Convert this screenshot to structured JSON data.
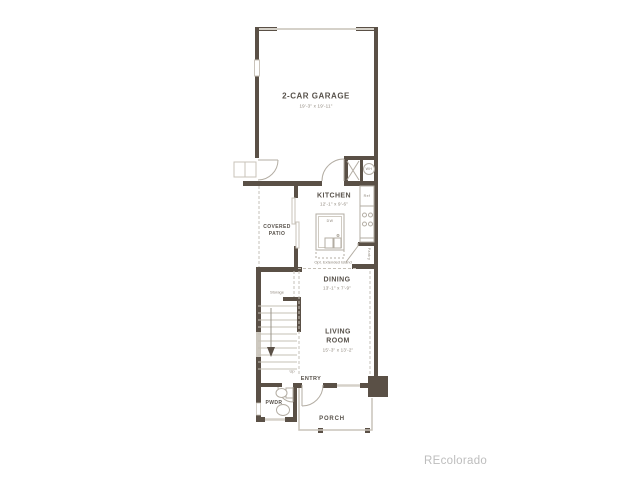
{
  "watermark": "REcolorado",
  "rooms": {
    "garage": {
      "name": "2-CAR GARAGE",
      "dims": "19'-3\" x 19'-11\""
    },
    "kitchen": {
      "name": "KITCHEN",
      "dims": "12'-1\" x 9'-6\""
    },
    "patio": {
      "line1": "COVERED",
      "line2": "PATIO"
    },
    "dining": {
      "name": "DINING",
      "dims": "13'-1\" x 7'-9\""
    },
    "living": {
      "line1": "LIVING",
      "line2": "ROOM",
      "dims": "15'-3\" x 13'-2\""
    },
    "entry": {
      "name": "ENTRY"
    },
    "pwdr": {
      "name": "PWDR"
    },
    "porch": {
      "name": "PORCH"
    },
    "storage": {
      "name": "Storage"
    }
  },
  "annotations": {
    "water_heater": "WH",
    "refrigerator": "Ref",
    "dishwasher": "DW",
    "pantry": "Pantry",
    "up": "Up",
    "optional_island": "Opt. Extended Island"
  },
  "colors": {
    "wall": "#5a5046",
    "light_line": "#c9c3ba",
    "fixture_line": "#b3ada3",
    "label_text": "#57514a",
    "dim_text": "#8d857a",
    "watermark": "#bdbdbd",
    "background": "#ffffff"
  }
}
